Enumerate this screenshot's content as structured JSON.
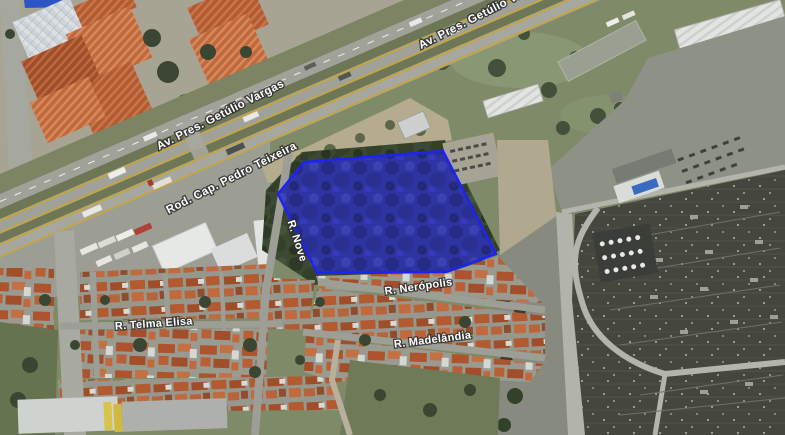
{
  "map": {
    "view": "satellite",
    "labels": {
      "av_vargas_top": "Av. Pres. Getúlio Vargas",
      "av_vargas_mid": "Av. Pres. Getúlio Vargas",
      "rod_teixeira": "Rod. Cap. Pedro Teixeira",
      "r_nove": "R. Nove",
      "r_neropolis": "R. Nerópolis",
      "r_madelandia": "R. Madelândia",
      "r_telma_elisa": "R. Telma Elisa"
    },
    "overlay": {
      "description": "highlighted land parcel polygon",
      "fill_color": "#2d33a6",
      "stroke_color": "#1e22f2"
    },
    "colors": {
      "road_yellow_line": "#c9a437",
      "roof_orange": "#b25b33",
      "vegetation_dark": "#3c4932",
      "substation_dark": "#45473f",
      "label_text": "#ffffff"
    }
  }
}
